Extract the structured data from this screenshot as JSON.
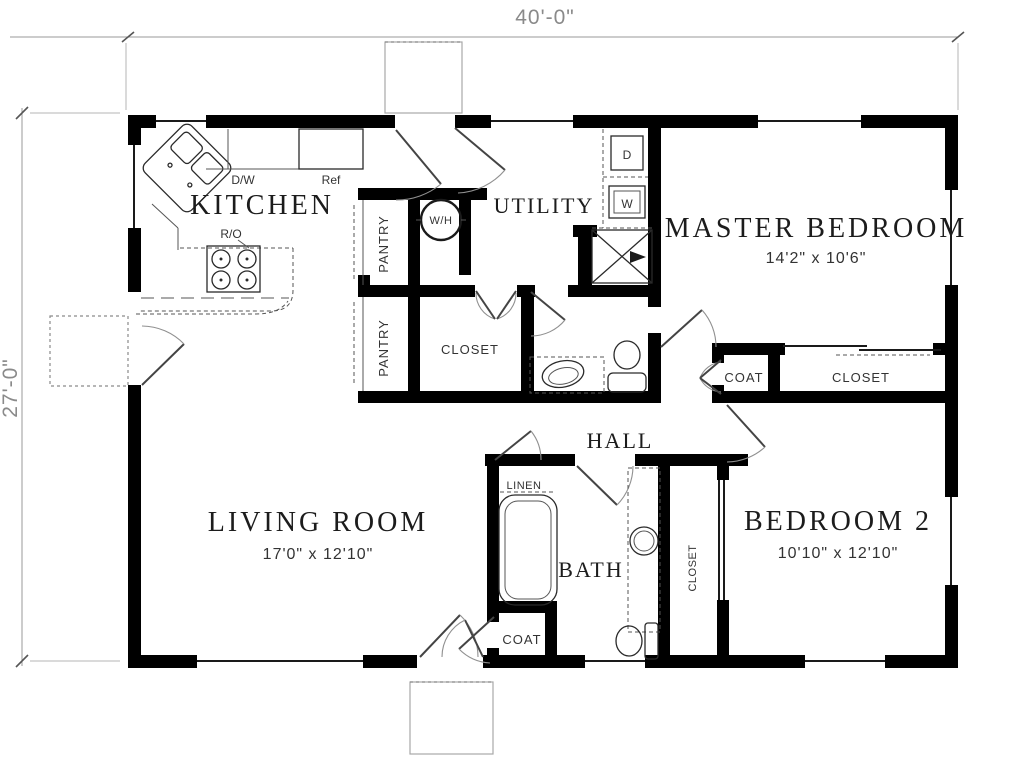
{
  "dims": {
    "width": "40'-0\"",
    "height": "27'-0\""
  },
  "rooms": {
    "kitchen": {
      "label": "KITCHEN"
    },
    "utility": {
      "label": "UTILITY"
    },
    "master": {
      "label": "MASTER BEDROOM",
      "size": "14'2\" x 10'6\""
    },
    "living": {
      "label": "LIVING ROOM",
      "size": "17'0\" x 12'10\""
    },
    "bedroom2": {
      "label": "BEDROOM 2",
      "size": "10'10\" x 12'10\""
    },
    "hall": {
      "label": "HALL"
    },
    "bath": {
      "label": "BATH"
    }
  },
  "closets": {
    "pantry1": "PANTRY",
    "pantry2": "PANTRY",
    "hall_closet": "CLOSET",
    "coat_hall": "COAT",
    "master_closet": "CLOSET",
    "linen": "LINEN",
    "bedroom2_closet": "CLOSET",
    "entry_coat": "COAT"
  },
  "appliances": {
    "dishwasher": "D/W",
    "refrigerator": "Ref",
    "range_oven": "R/O",
    "water_heater": "W/H",
    "dryer": "D",
    "washer": "W"
  }
}
